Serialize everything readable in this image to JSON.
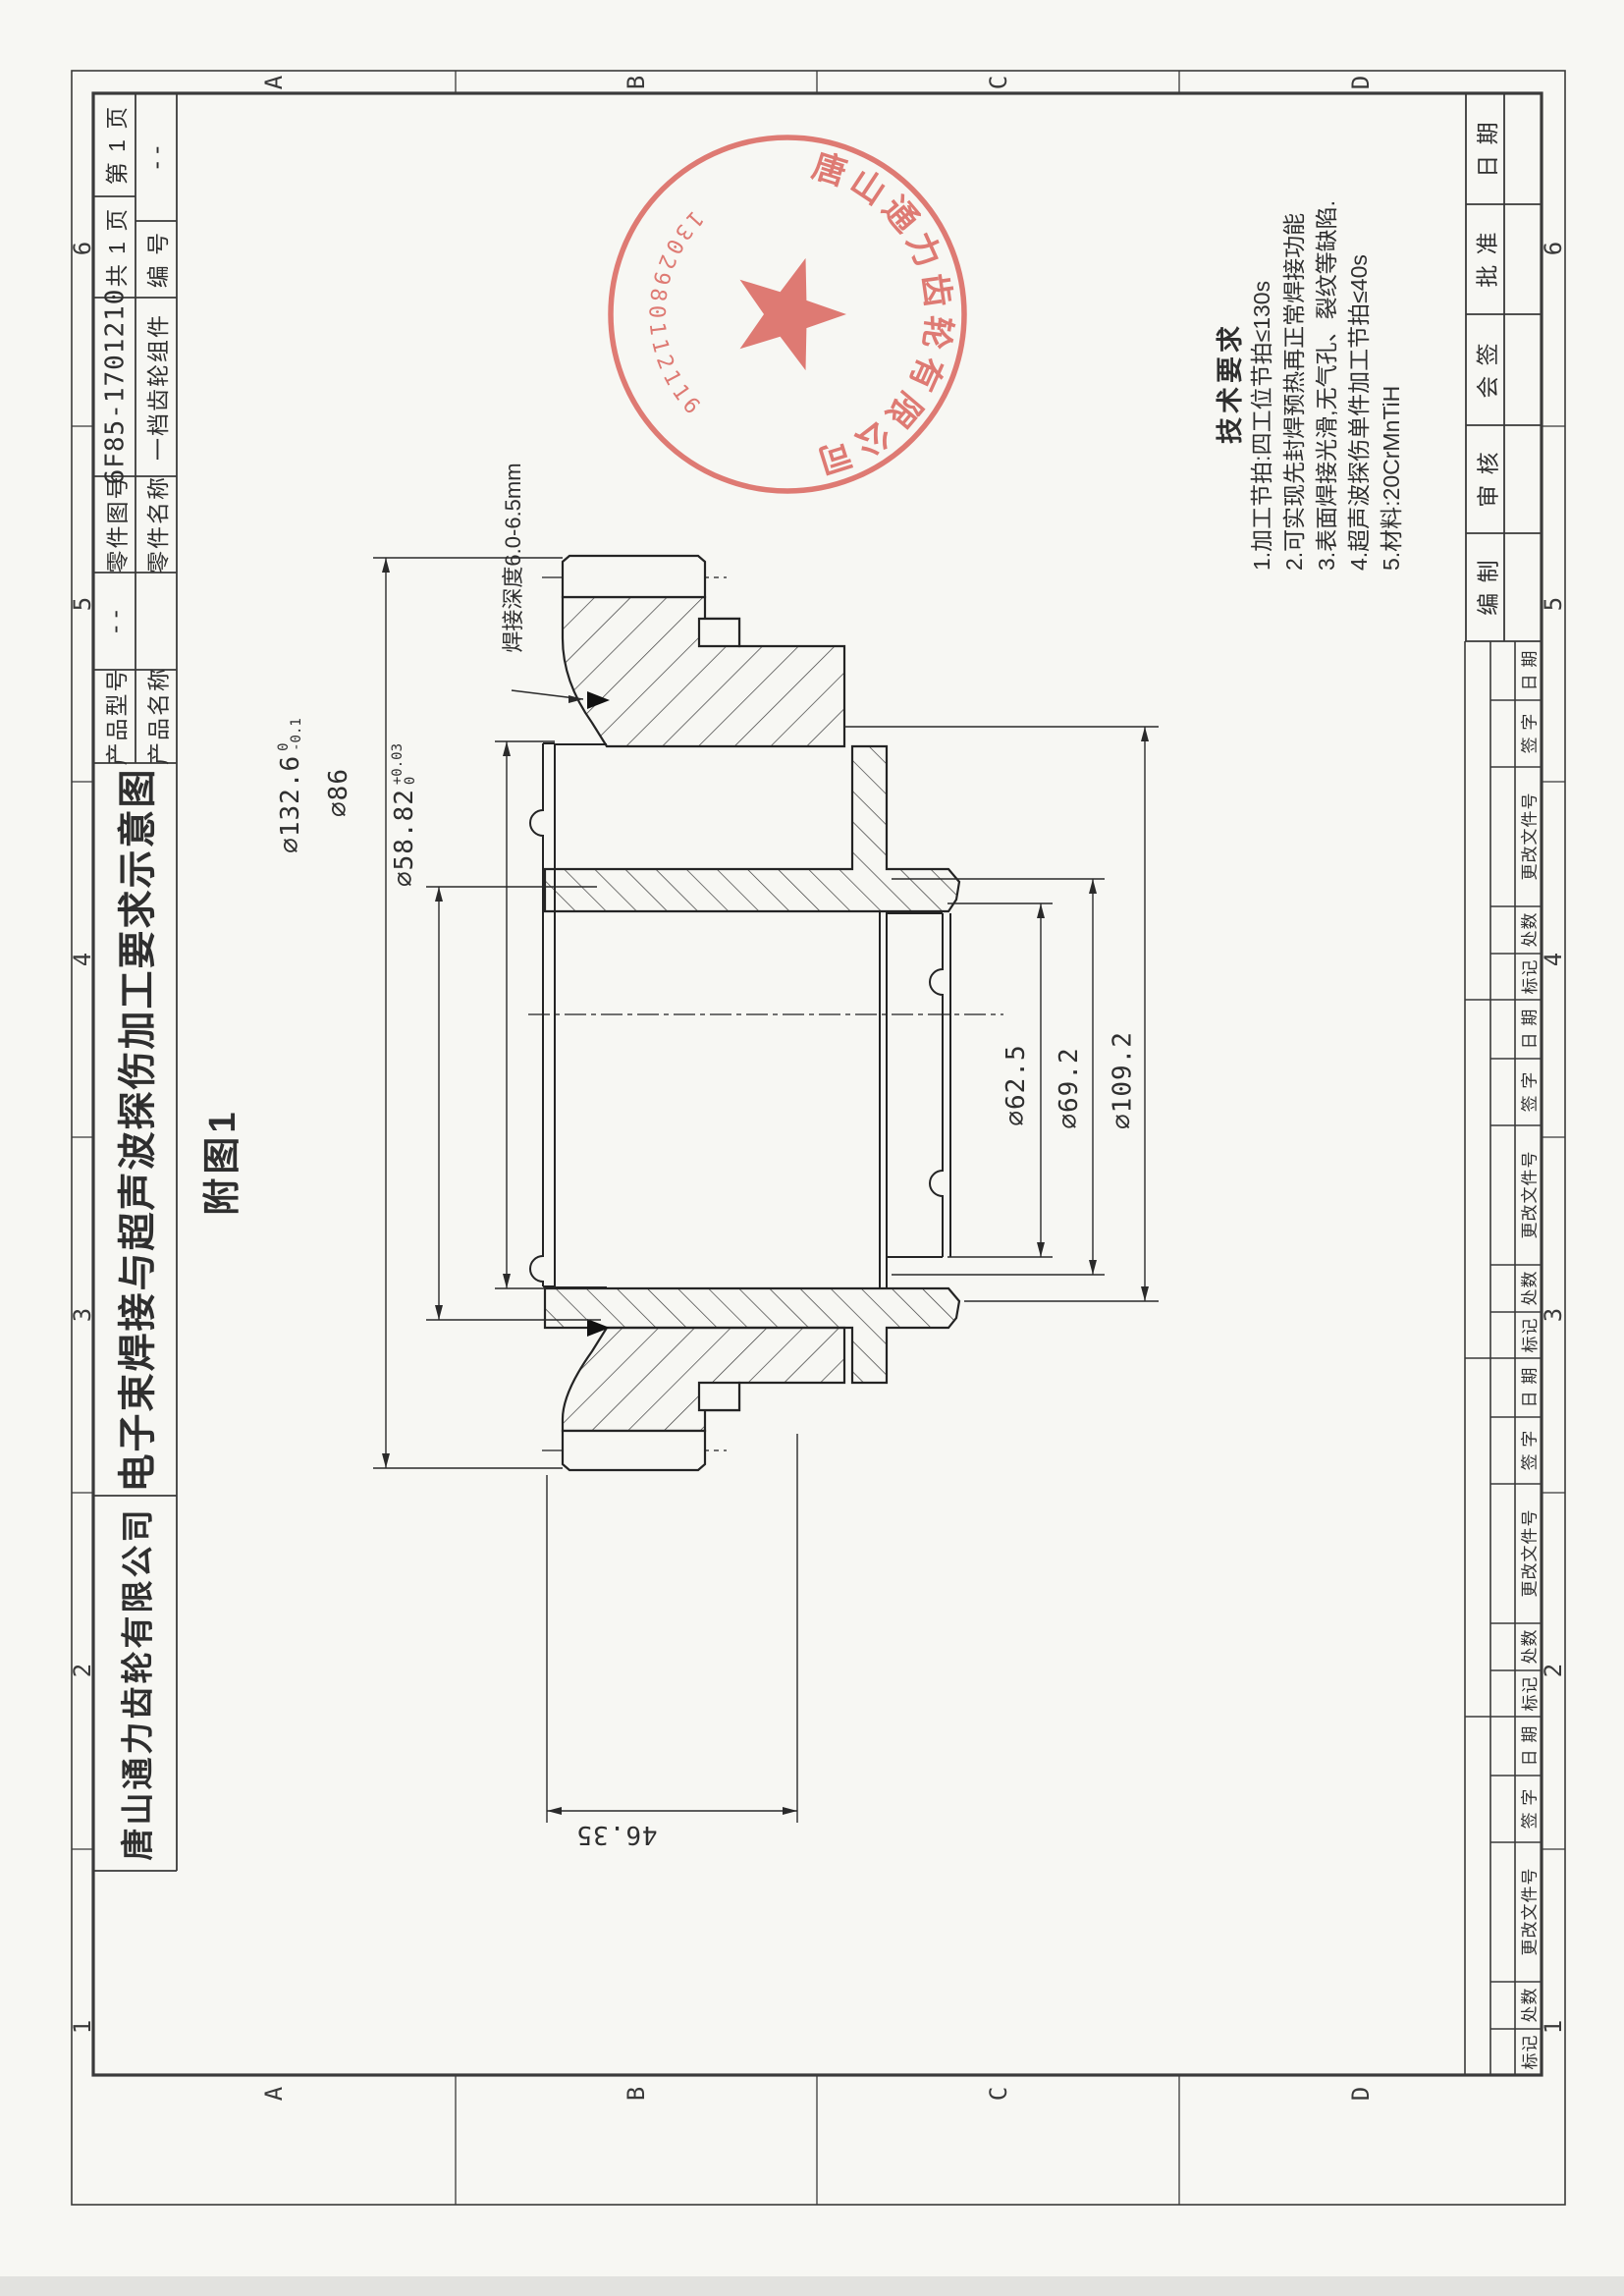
{
  "zones": {
    "letters": [
      "A",
      "B",
      "C",
      "D"
    ],
    "numbers": [
      "6",
      "5",
      "4",
      "3",
      "2",
      "1"
    ]
  },
  "title_block": {
    "page_no": "第 1 页",
    "pages_total": "共 1 页",
    "part_no": "6F85-1701210",
    "part_no_label": "零件图号",
    "part_name": "一档齿轮组件",
    "part_name_label": "零件名称",
    "serial_label": "编 号",
    "serial_value": "--",
    "model_label": "产品型号",
    "model_value": "--",
    "product_name_label": "产品名称",
    "doc_title": "电子束焊接与超声波探伤加工要求示意图",
    "company": "唐山通力齿轮有限公司"
  },
  "sign_block": {
    "date": "日 期",
    "approve": "批 准",
    "joint_sign": "会 签",
    "check": "审 核",
    "compile": "编 制"
  },
  "revision": {
    "date": "日 期",
    "sign": "签 字",
    "doc_no": "更改文件号",
    "count": "处数",
    "mark": "标记"
  },
  "tech": {
    "title": "技术要求",
    "line1": "1.加工节拍:四工位节拍≤130s",
    "line2": "2.可实现先封焊预热再正常焊接功能",
    "line3": "3.表面焊接光滑,无气孔、裂纹等缺陷.",
    "line4": "4.超声波探伤单件加工节拍≤40s",
    "line5": "5.材料:20CrMnTiH"
  },
  "dims": {
    "d132": {
      "text": "∅132.6",
      "tol_up": "0",
      "tol_dn": "-0.1"
    },
    "d86": {
      "text": "∅86"
    },
    "d5882": {
      "text": "∅58.82",
      "tol_up": "+0.03",
      "tol_dn": "0"
    },
    "d625": {
      "text": "∅62.5"
    },
    "d692": {
      "text": "∅69.2"
    },
    "d1092": {
      "text": "∅109.2"
    },
    "d4635": {
      "text": "46.35"
    },
    "weld_note": "焊接深度6.0-6.5mm"
  },
  "figure_label": "附图1",
  "stamp": {
    "company": "唐山通力齿轮有限公司",
    "number": "1302980112116"
  }
}
